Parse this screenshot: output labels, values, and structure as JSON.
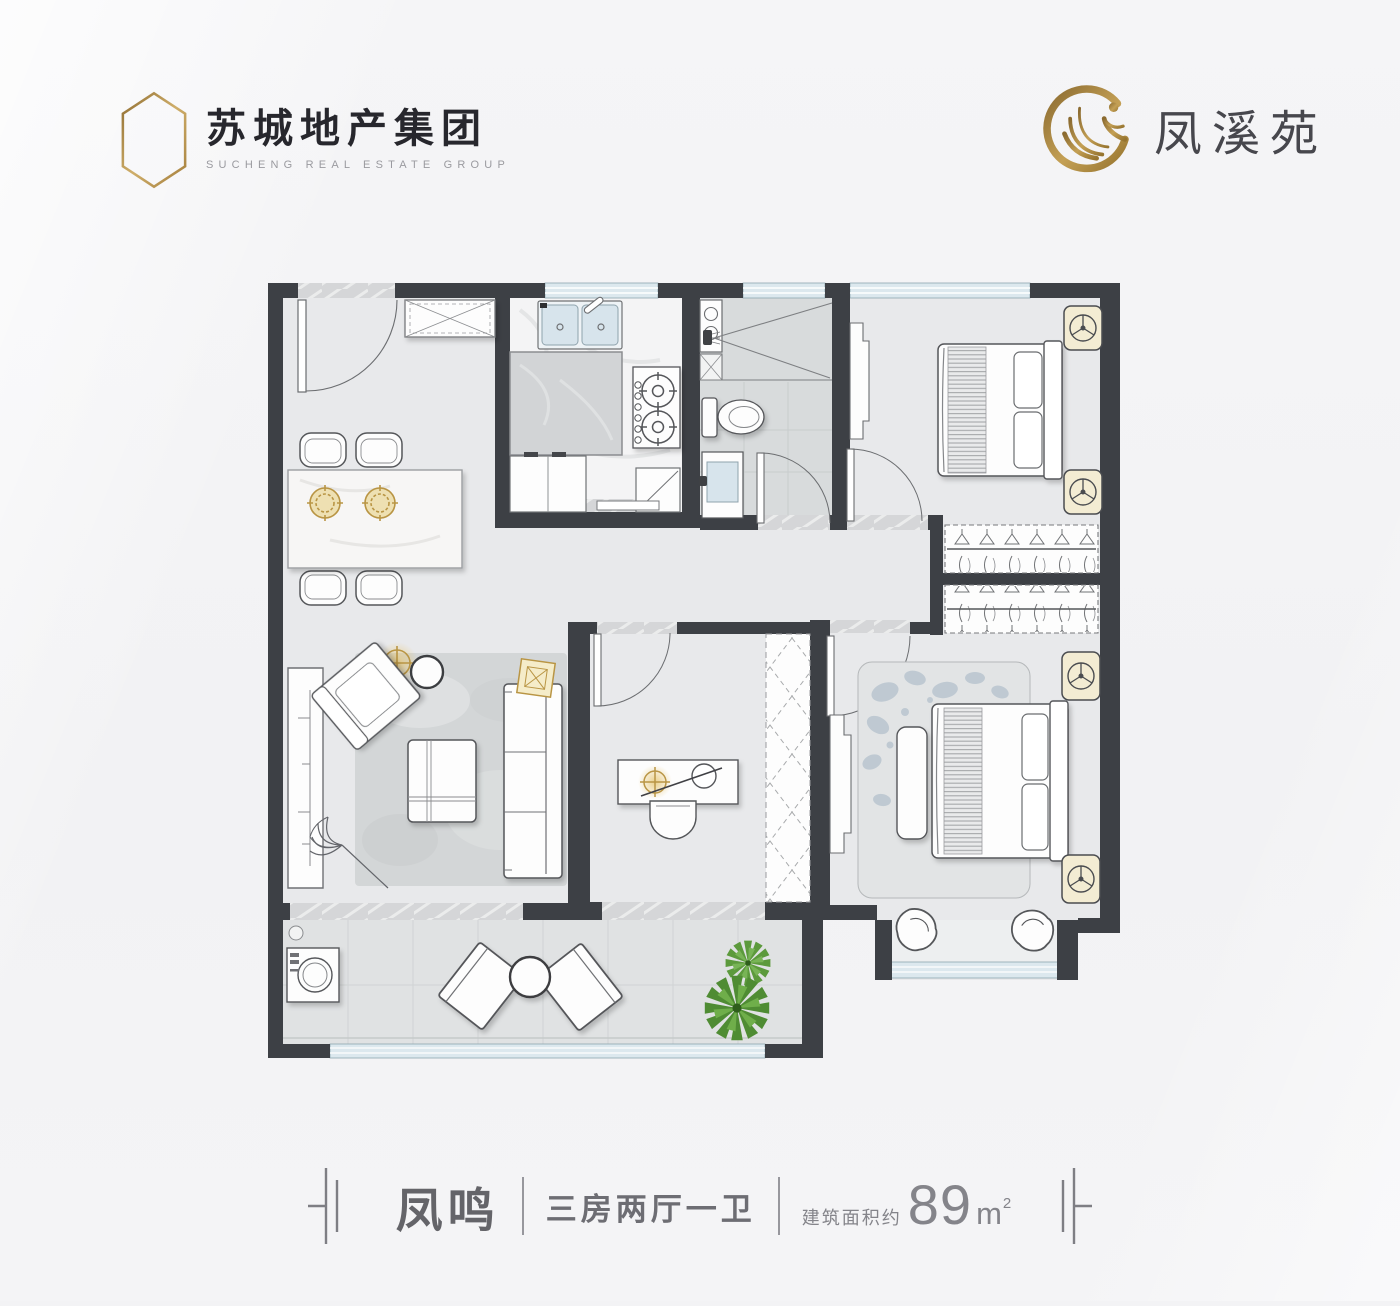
{
  "header": {
    "developer": {
      "icon": "building-icon",
      "name_cn": "苏城地产集团",
      "name_en": "SUCHENG REAL ESTATE GROUP"
    },
    "project": {
      "icon": "phoenix-icon",
      "name_cn": "凤溪苑"
    }
  },
  "footer": {
    "unit_name": "凤鸣",
    "layout_type": "三房两厅一卫",
    "area_label": "建筑面积约",
    "area_value": "89",
    "area_unit": "m",
    "area_superscript": "2"
  },
  "colors": {
    "gold_accent": "#b9934e",
    "wall": "#3d4045",
    "glass": "#dce8ee",
    "text_dark": "#27272d",
    "text_gray": "#6d6d73"
  }
}
